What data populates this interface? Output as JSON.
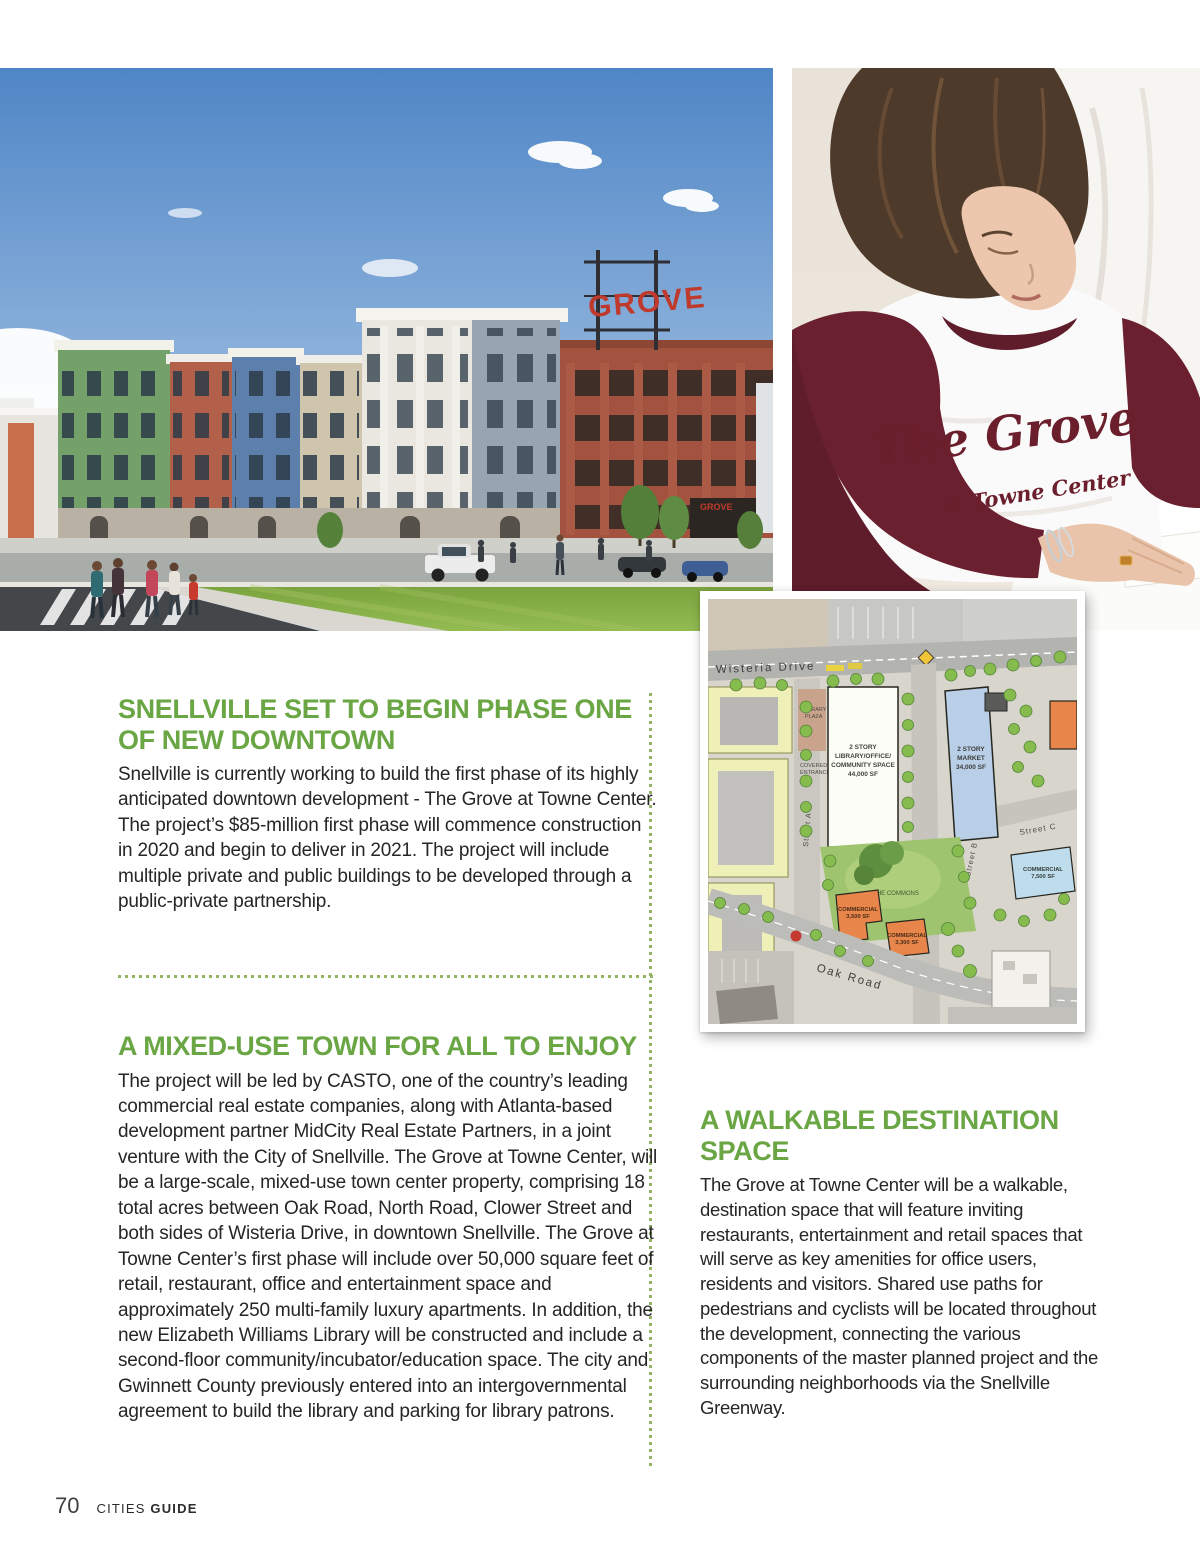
{
  "page": {
    "footer": {
      "page_number": "70",
      "brand_regular": "CITIES",
      "brand_bold": "GUIDE"
    }
  },
  "colors": {
    "heading_green": "#6aa644",
    "divider_green": "#93b463",
    "body_text": "#262626",
    "shirt_maroon": "#6b2030",
    "garage_brick": "#a2523e",
    "sky_blue": "#5b8cc8",
    "grass_green": "#7ba43e"
  },
  "articles": {
    "phase_one": {
      "heading": "SNELLVILLE SET TO BEGIN PHASE ONE OF NEW DOWNTOWN",
      "body": "Snellville is currently working to build the first phase of its highly anticipated downtown development - The Grove at Towne Center. The project’s $85-million first phase will commence construction in 2020 and begin to deliver in 2021. The project will include multiple private and public buildings to be developed through a public-private partnership."
    },
    "mixed_use": {
      "heading": "A MIXED-USE TOWN FOR ALL TO ENJOY",
      "body": "The project will be led by CASTO, one of the country’s leading commercial real estate companies, along with Atlanta-based development partner MidCity Real Estate Partners, in a joint venture with the City of Snellville. The Grove at Towne Center, will be a large-scale, mixed-use town center property, comprising 18 total acres between Oak Road, North Road, Clower Street and both sides of Wisteria Drive, in downtown Snellville. The Grove at Towne Center’s first phase will include over 50,000 square feet of retail, restaurant, office and entertainment space and approximately 250 multi-family luxury apartments.  In addition, the new Elizabeth Williams Library will be constructed and include a second-floor community/incubator/education space. The city and Gwinnett County previously entered into an intergovernmental agreement to build the library and parking for library patrons."
    },
    "walkable": {
      "heading": "A WALKABLE DESTINATION SPACE",
      "body": "The Grove at Towne Center will be a walkable, destination space that will feature inviting restaurants, entertainment and retail spaces that will serve as key amenities for office users, residents and visitors. Shared use paths for pedestrians and cyclists will be located throughout the development, connecting the various components of the master planned project and the surrounding neighborhoods via the Snellville Greenway."
    }
  },
  "rendering_photo": {
    "grove_sign": "GROVE"
  },
  "shirt_photo": {
    "shirt_line1": "The Grove",
    "shirt_line2": "at Towne Center"
  },
  "site_plan": {
    "streets": {
      "wisteria": "Wisteria Drive",
      "street_a": "Street A",
      "street_b": "Street B",
      "street_c": "Street C",
      "oak_road": "Oak Road"
    },
    "areas": {
      "commons": "THE COMMONS",
      "library_plaza_1": "LIBRARY",
      "library_plaza_2": "PLAZA",
      "covered_1": "COVERED",
      "covered_2": "ENTRANCE"
    },
    "buildings": {
      "library": {
        "l1": "2 STORY",
        "l2": "LIBRARY/OFFICE/",
        "l3": "COMMUNITY SPACE",
        "l4": "44,000 SF"
      },
      "market": {
        "l1": "2 STORY",
        "l2": "MARKET",
        "l3": "34,000 SF"
      },
      "comm_blue": {
        "l1": "COMMERCIAL",
        "l2": "7,500 SF"
      },
      "comm_a": {
        "l1": "COMMERCIAL",
        "l2": "3,500 SF"
      },
      "comm_b": {
        "l1": "COMMERCIAL",
        "l2": "3,300 SF"
      }
    }
  }
}
